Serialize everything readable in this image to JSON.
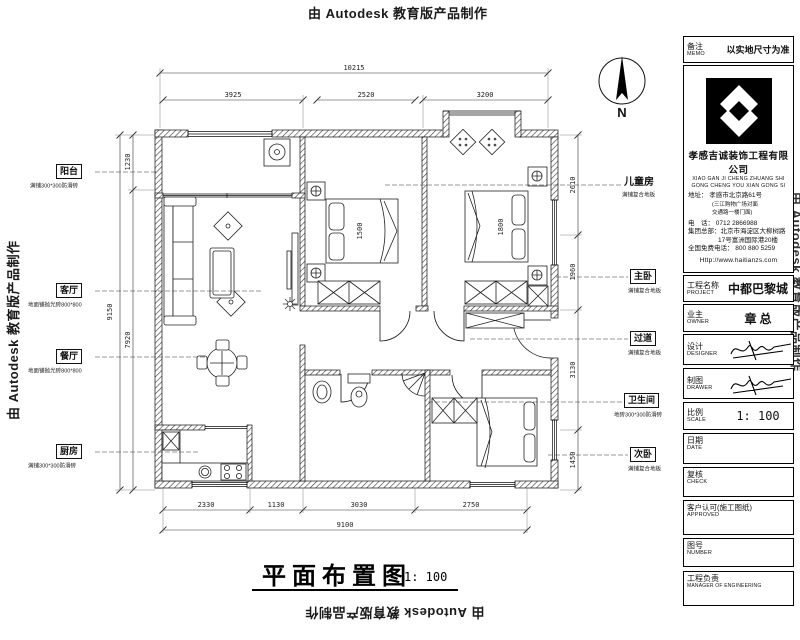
{
  "watermark": {
    "text": "由 Autodesk 教育版产品制作"
  },
  "north": {
    "label": "N"
  },
  "plan_title": {
    "text": "平面布置图",
    "scale": "1: 100"
  },
  "plan": {
    "rooms": [
      {
        "name": "阳台",
        "note": "满铺300*300防滑砖"
      },
      {
        "name": "客厅",
        "note": "地面铺抛光砖800*800"
      },
      {
        "name": "餐厅",
        "note": "地面铺抛光砖800*800"
      },
      {
        "name": "厨房",
        "note": "满铺300*300防滑砖"
      },
      {
        "name": "儿童房",
        "note": "满铺复合地板"
      },
      {
        "name": "主卧",
        "note": "满铺复合地板"
      },
      {
        "name": "过道",
        "note": "满铺复合地板"
      },
      {
        "name": "卫生间",
        "note": "地砖300*300防滑砖"
      },
      {
        "name": "次卧",
        "note": "满铺复合地板"
      }
    ],
    "beds": {
      "child": "1500",
      "master": "1800"
    },
    "dims": {
      "top_overall": "10215",
      "top_segments": [
        "3925",
        "2520",
        "3200"
      ],
      "bottom_segments": [
        "2330",
        "1130",
        "3030",
        "2750"
      ],
      "bottom_overall": "9100",
      "left_overall": "9150",
      "left_segments": [
        "1230",
        "7920"
      ],
      "right_segments": [
        "2610",
        "1960",
        "3130",
        "1450"
      ]
    }
  },
  "titleblock": {
    "memo": {
      "zh": "备注",
      "en": "MEMO",
      "value": "以实地尺寸为准"
    },
    "company": {
      "name": "孝感吉诚装饰工程有限公司",
      "pinyin1": "XIAO GAN JI CHENG ZHUANG SHI",
      "pinyin2": "GONG CHENG YOU XIAN GONG SI",
      "addr": "地址：  孝感市北京路61号",
      "addr_note1": "(三江购物广场对面",
      "addr_note2": "交通路一楼门面)",
      "tel": "电　话：  0712 2866988",
      "hq1": "集团总部：北京市海淀区大柳树路",
      "hq2": "17号富洲国际港20楼",
      "free": "全国免费电话： 800 880 5259",
      "web": "Http://www.haitianzs.com"
    },
    "rows": [
      {
        "zh": "工程名称",
        "en": "PROJECT",
        "value": "中都巴黎城"
      },
      {
        "zh": "业主",
        "en": "OWNER",
        "value": "章 总"
      },
      {
        "zh": "设计",
        "en": "DESIGNER",
        "value": ""
      },
      {
        "zh": "制图",
        "en": "DRAWER",
        "value": ""
      },
      {
        "zh": "比例",
        "en": "SCALE",
        "value": "1: 100"
      },
      {
        "zh": "日期",
        "en": "DATE",
        "value": ""
      },
      {
        "zh": "复核",
        "en": "CHECK",
        "value": ""
      },
      {
        "zh": "客户认可(施工图纸)",
        "en": "APPROVED",
        "value": ""
      },
      {
        "zh": "图号",
        "en": "NUMBER",
        "value": ""
      },
      {
        "zh": "工程负责",
        "en": "MANAGER OF ENGINEERING",
        "value": ""
      }
    ]
  }
}
